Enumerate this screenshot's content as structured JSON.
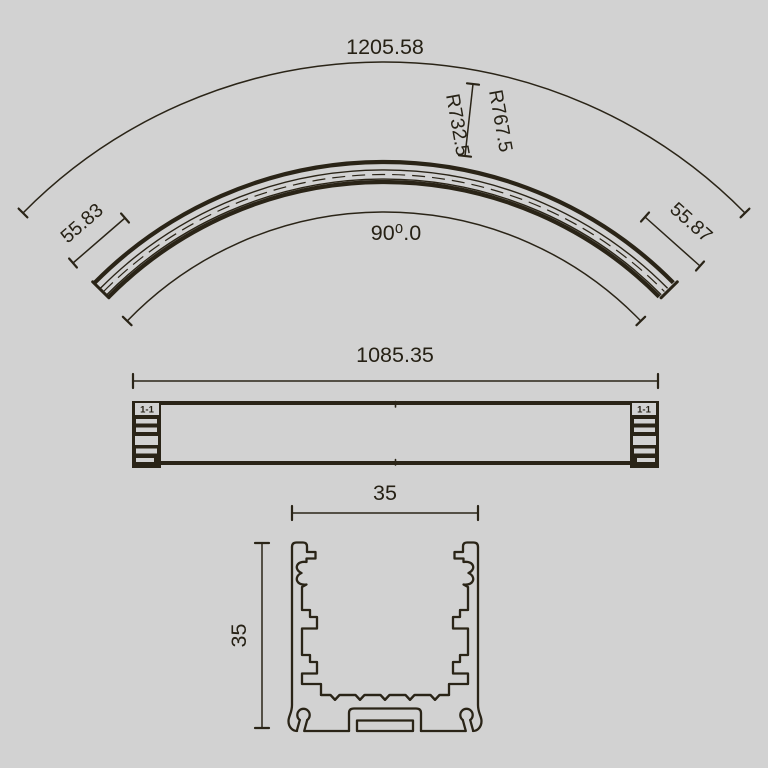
{
  "drawing": {
    "type": "technical-dimension-drawing",
    "subject": "curved track / aluminium profile, three orthographic views",
    "colors": {
      "background": "#d2d2d2",
      "line": "#2a2417",
      "text": "#262115"
    },
    "plan_view": {
      "chord_length": "1205.58",
      "outer_radius_label": "R767.5",
      "inner_radius_label": "R732.5",
      "arc_angle": "90⁰.0",
      "left_end_length": "55.83",
      "right_end_length": "55.87"
    },
    "side_view": {
      "overall_length": "1085.35",
      "section_mark_left": "1-1",
      "section_mark_right": "1-1"
    },
    "cross_section": {
      "width": "35",
      "height": "35"
    }
  }
}
